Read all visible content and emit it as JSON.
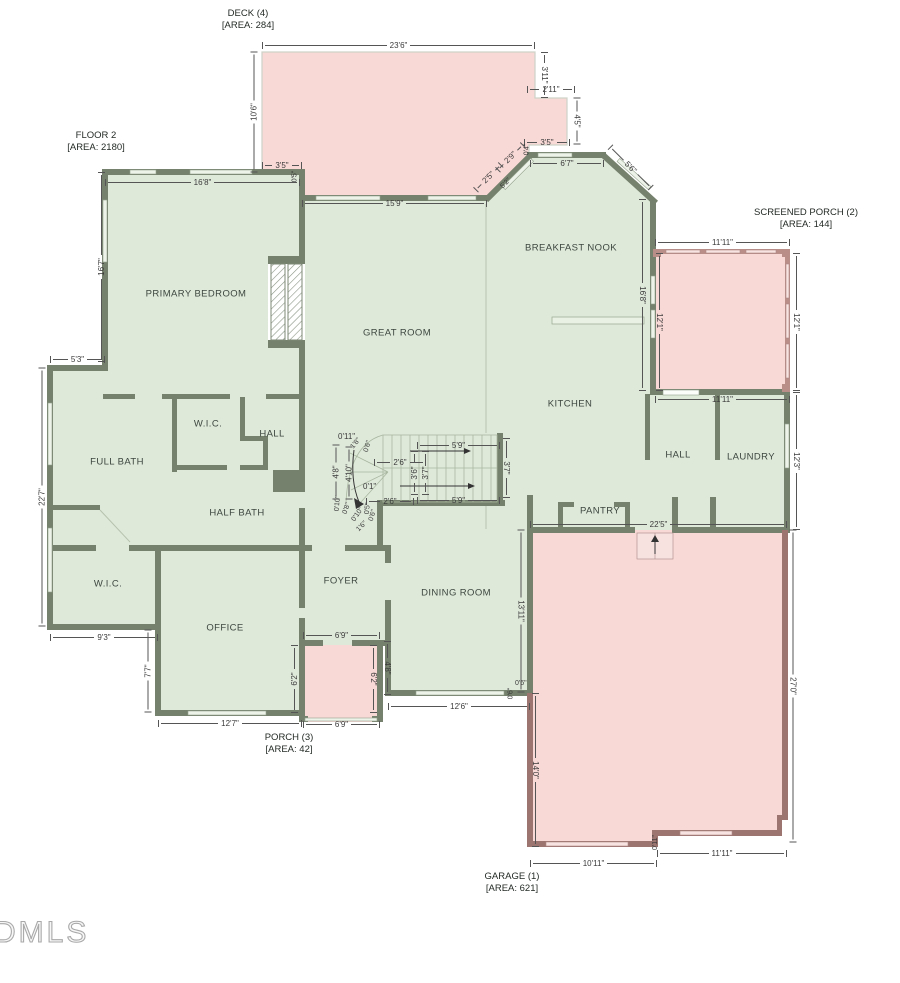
{
  "meta": {
    "watermark": "DMLS"
  },
  "colors": {
    "interior_fill": "#dfe9da",
    "outdoor_fill": "#f9d9d6",
    "house_wall": "#75816c",
    "garage_wall": "#9c7470",
    "porch_wall": "#b98d88",
    "dimension": "#3a3a3a"
  },
  "areas": {
    "floor": {
      "name": "FLOOR 2",
      "area": "[AREA: 2180]"
    },
    "deck": {
      "name": "DECK (4)",
      "area": "[AREA: 284]"
    },
    "sporch": {
      "name": "SCREENED PORCH (2)",
      "area": "[AREA: 144]"
    },
    "porch": {
      "name": "PORCH (3)",
      "area": "[AREA: 42]"
    },
    "garage": {
      "name": "GARAGE (1)",
      "area": "[AREA: 621]"
    }
  },
  "rooms": {
    "primary_bedroom": "PRIMARY BEDROOM",
    "great_room": "GREAT ROOM",
    "breakfast_nook": "BREAKFAST NOOK",
    "kitchen": "KITCHEN",
    "full_bath": "FULL BATH",
    "wic_upper": "W.I.C.",
    "hall_left": "HALL",
    "half_bath": "HALF BATH",
    "wic_lower": "W.I.C.",
    "office": "OFFICE",
    "foyer": "FOYER",
    "dining_room": "DINING ROOM",
    "hall_right": "HALL",
    "laundry": "LAUNDRY",
    "pantry": "PANTRY"
  },
  "dims": {
    "deck_top": "23'6\"",
    "deck_left": "10'6\"",
    "deck_right_upper": "3'11\"",
    "deck_notch": "2'11\"",
    "deck_right_lower": "4'5\"",
    "deck_bottom_right": "3'5\"",
    "deck_corner": "0'4\"",
    "deck_bottom_left": "3'5\"",
    "deck_step": "0'5\"",
    "bay_upper": "2'5\"",
    "bay_lower": "2'9\"",
    "bay_wall": "5'2\"",
    "nook_top": "6'7\"",
    "nook_diag": "5'6\"",
    "great_room_top": "15'9\"",
    "bedroom_top": "16'8\"",
    "bedroom_left": "16'7\"",
    "left_step": "5'3\"",
    "left_side": "22'7\"",
    "wic_bottom": "9'3\"",
    "office_left": "7'7\"",
    "office_bottom": "12'7\"",
    "porch_top": "6'9\"",
    "porch_left": "6'2\"",
    "porch_inner": "6'2\"",
    "porch_side": "4'8\"",
    "porch_bottom": "6'9\"",
    "dining_bottom": "12'6\"",
    "dining_right": "13'11\"",
    "dining_corner_h": "0'6\"",
    "dining_corner_v": "0'6\"",
    "garage_top": "22'5\"",
    "garage_right": "27'0\"",
    "garage_left": "14'0\"",
    "garage_bottom_left": "10'11\"",
    "garage_bottom_right": "11'11\"",
    "garage_step": "0'11\"",
    "sporch_top": "11'11\"",
    "sporch_left": "12'1\"",
    "sporch_right": "12'1\"",
    "sporch_bottom": "11'11\"",
    "kitchen_side": "16'8\"",
    "laundry_side": "12'3\"",
    "st_top": "0'11\"",
    "st_diag1": "1'8\"",
    "st_diag2": "0'6\"",
    "st_left": "4'8\"",
    "st_left_inner": "4'10\"",
    "st_run_top": "2'6\"",
    "st_w_a": "3'6\"",
    "st_w_b": "3'7\"",
    "st_top_len": "5'9\"",
    "st_right": "3'7\"",
    "st_tiny": "0'1\"",
    "st_run_bot": "2'6\"",
    "st_bot_len": "5'9\"",
    "wind_a": "0'10\"",
    "wind_b": "0'8\"",
    "wind_c": "0'10\"",
    "wind_d": "0'5\"",
    "wind_e": "0'6\"",
    "wind_f": "1'6\""
  }
}
